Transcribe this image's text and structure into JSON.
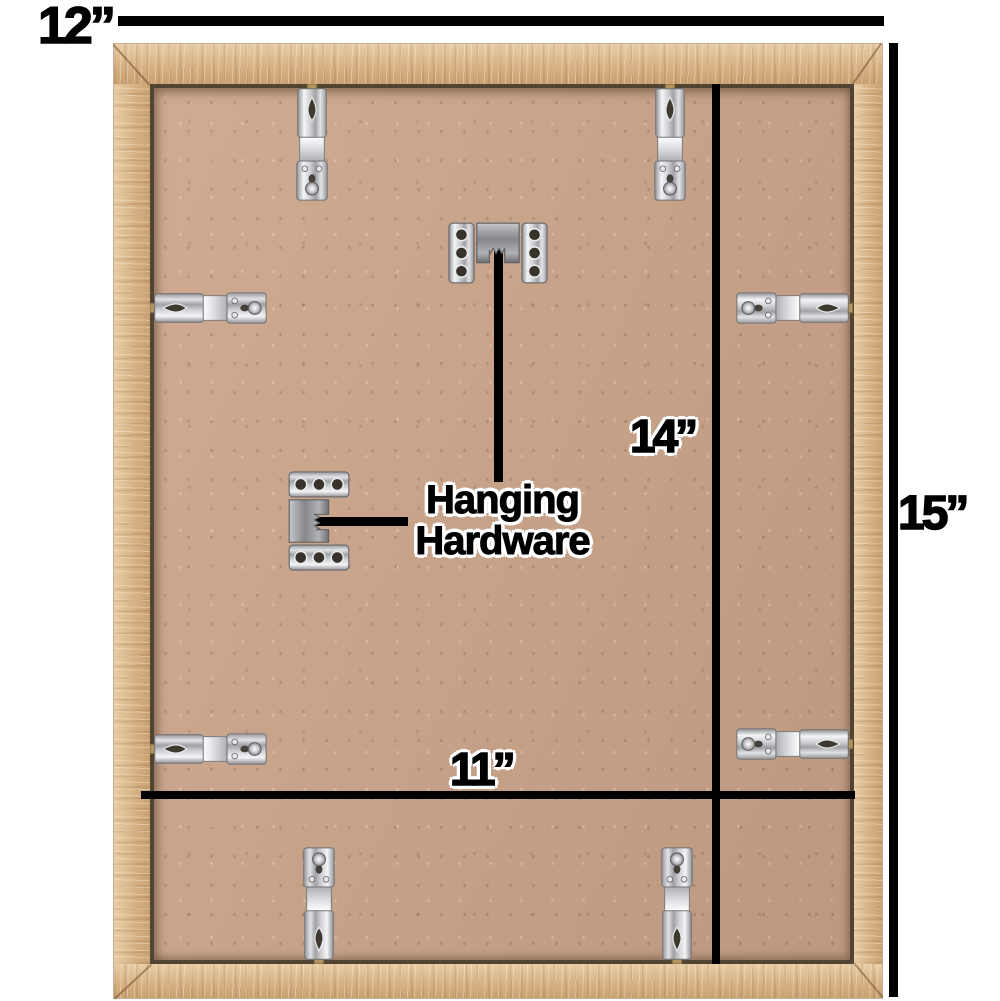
{
  "dimension_labels": {
    "outer_width": "12”",
    "outer_height": "15”",
    "inner_height": "14”",
    "inner_width": "11”"
  },
  "annotations": {
    "hanging_hardware_line1": "Hanging",
    "hanging_hardware_line2": "Hardware"
  },
  "icons": {
    "spring_clip": "spring-clip-icon",
    "sawtooth_hanger": "sawtooth-hanger-icon"
  },
  "colors": {
    "background": "#ffffff",
    "dimension_lines": "#000000",
    "frame_wood": "#d9b489",
    "backing_board": "#cba489",
    "hardware_metal": "#c7c9cc",
    "label_outline": "#ffffff"
  }
}
